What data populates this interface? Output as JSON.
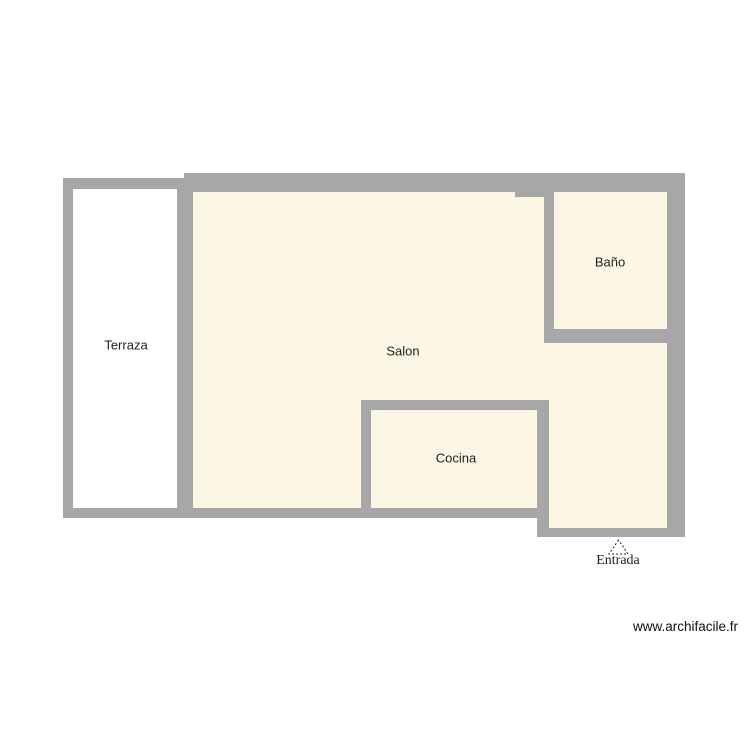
{
  "plan": {
    "rooms": [
      {
        "id": "terraza",
        "name": "Terraza"
      },
      {
        "id": "salon",
        "name": "Salon"
      },
      {
        "id": "bano",
        "name": "Baño"
      },
      {
        "id": "cocina",
        "name": "Cocina"
      }
    ],
    "entrance": {
      "label": "Entrada",
      "marker": "dashed-triangle"
    },
    "colors": {
      "wall": "#a7a7a7",
      "floor": "#fcf7e5",
      "terrace_floor": "#ffffff",
      "text": "#1f1f1f"
    }
  },
  "watermark": "www.archifacile.fr"
}
